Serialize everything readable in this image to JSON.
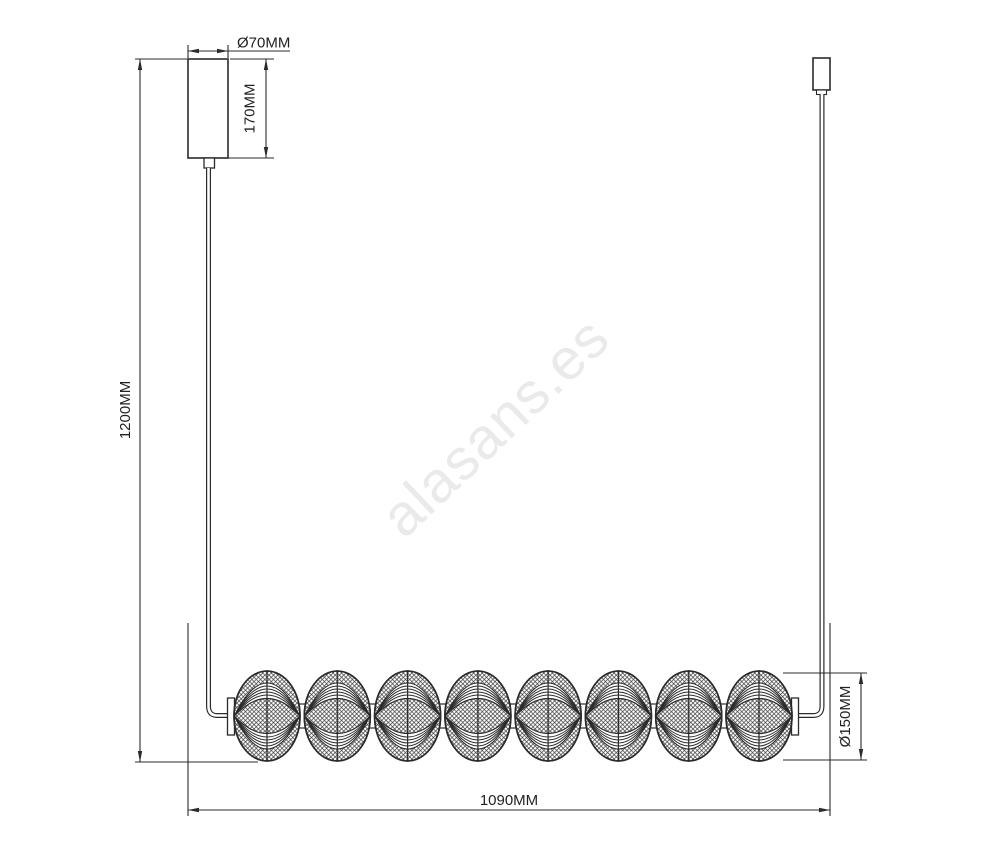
{
  "watermark": {
    "text": "alasans.es",
    "color": "#eaeaea",
    "angle_deg": -43.5
  },
  "diagram": {
    "type": "technical-drawing",
    "figure": {
      "sphere_count": 8,
      "units": "MM"
    },
    "labels": {
      "canopy_diameter": "Ø70MM",
      "canopy_height": "170MM",
      "suspension_drop": "1200MM",
      "fixture_length": "1090MM",
      "sphere_diameter": "Ø150MM"
    },
    "colors": {
      "line": "#2b2b2b",
      "background": "#ffffff"
    }
  }
}
